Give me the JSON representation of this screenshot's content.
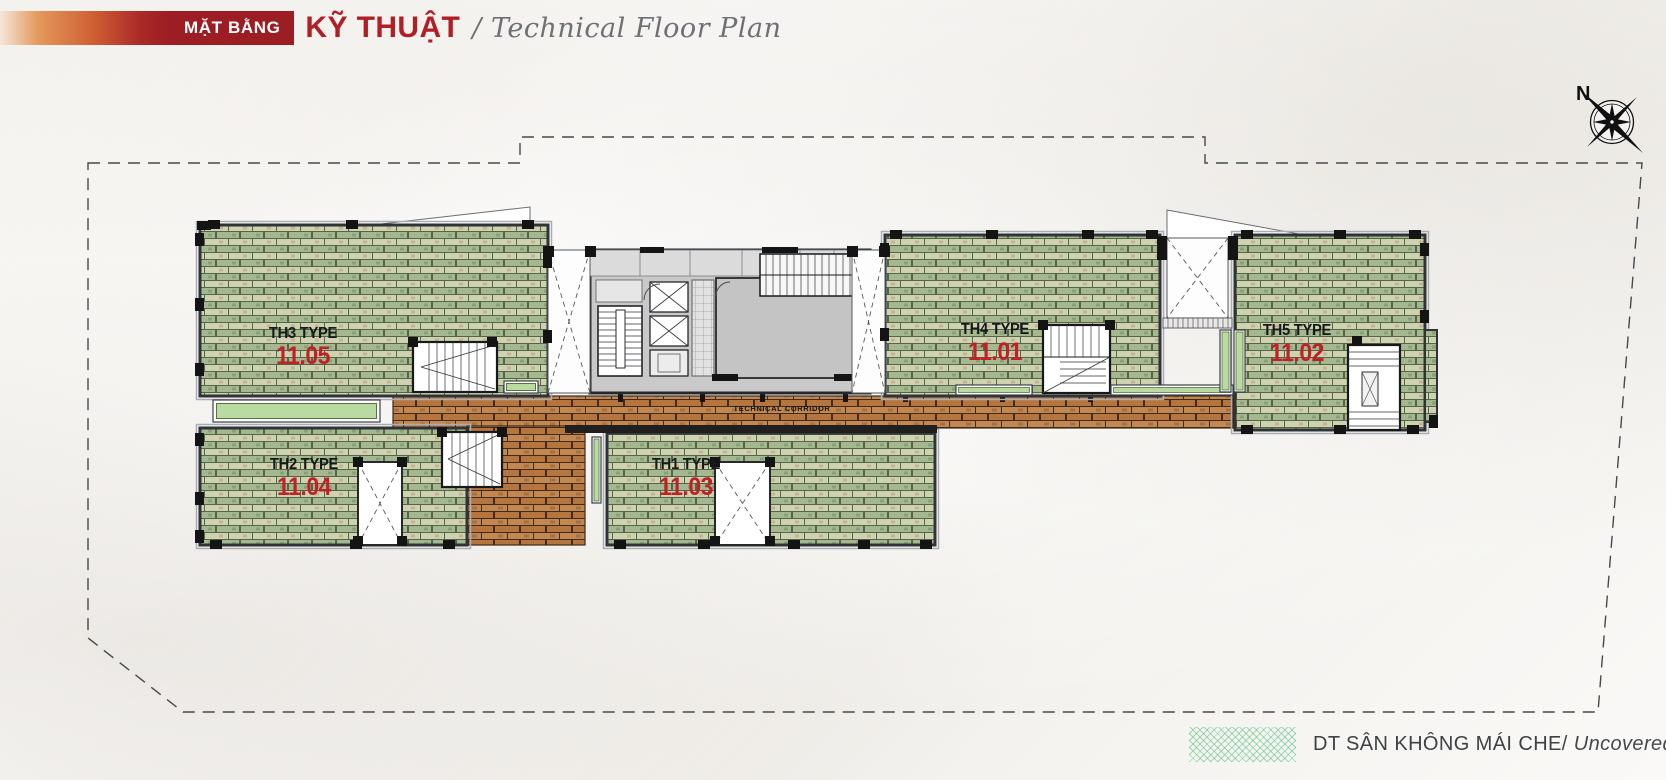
{
  "header": {
    "badge": "MẶT BẰNG",
    "title_vi": "KỸ THUẬT",
    "title_en": "/ Technical Floor Plan"
  },
  "compass": {
    "north_label": "N"
  },
  "plan": {
    "corridor_label": "TECHNICAL CORRIDOR",
    "units": [
      {
        "type_label": "TH4 TYPE",
        "number": "11.01"
      },
      {
        "type_label": "TH5 TYPE",
        "number": "11.02"
      },
      {
        "type_label": "TH1 TYPE",
        "number": "11.03"
      },
      {
        "type_label": "TH2 TYPE",
        "number": "11.04"
      },
      {
        "type_label": "TH3 TYPE",
        "number": "11.05"
      }
    ]
  },
  "legend": {
    "label_vi": "DT SÂN KHÔNG MÁI CHE/",
    "label_en": "Uncovered Yard"
  },
  "colors": {
    "accent_red": "#b01f26",
    "badge_red": "#9c1d23",
    "unit_number_red": "#bf2127",
    "brick_green": "#a4b78e",
    "brick_brown": "#bc8150",
    "yard_green": "#8fc79a",
    "core_gray": "#c9c9c9"
  }
}
